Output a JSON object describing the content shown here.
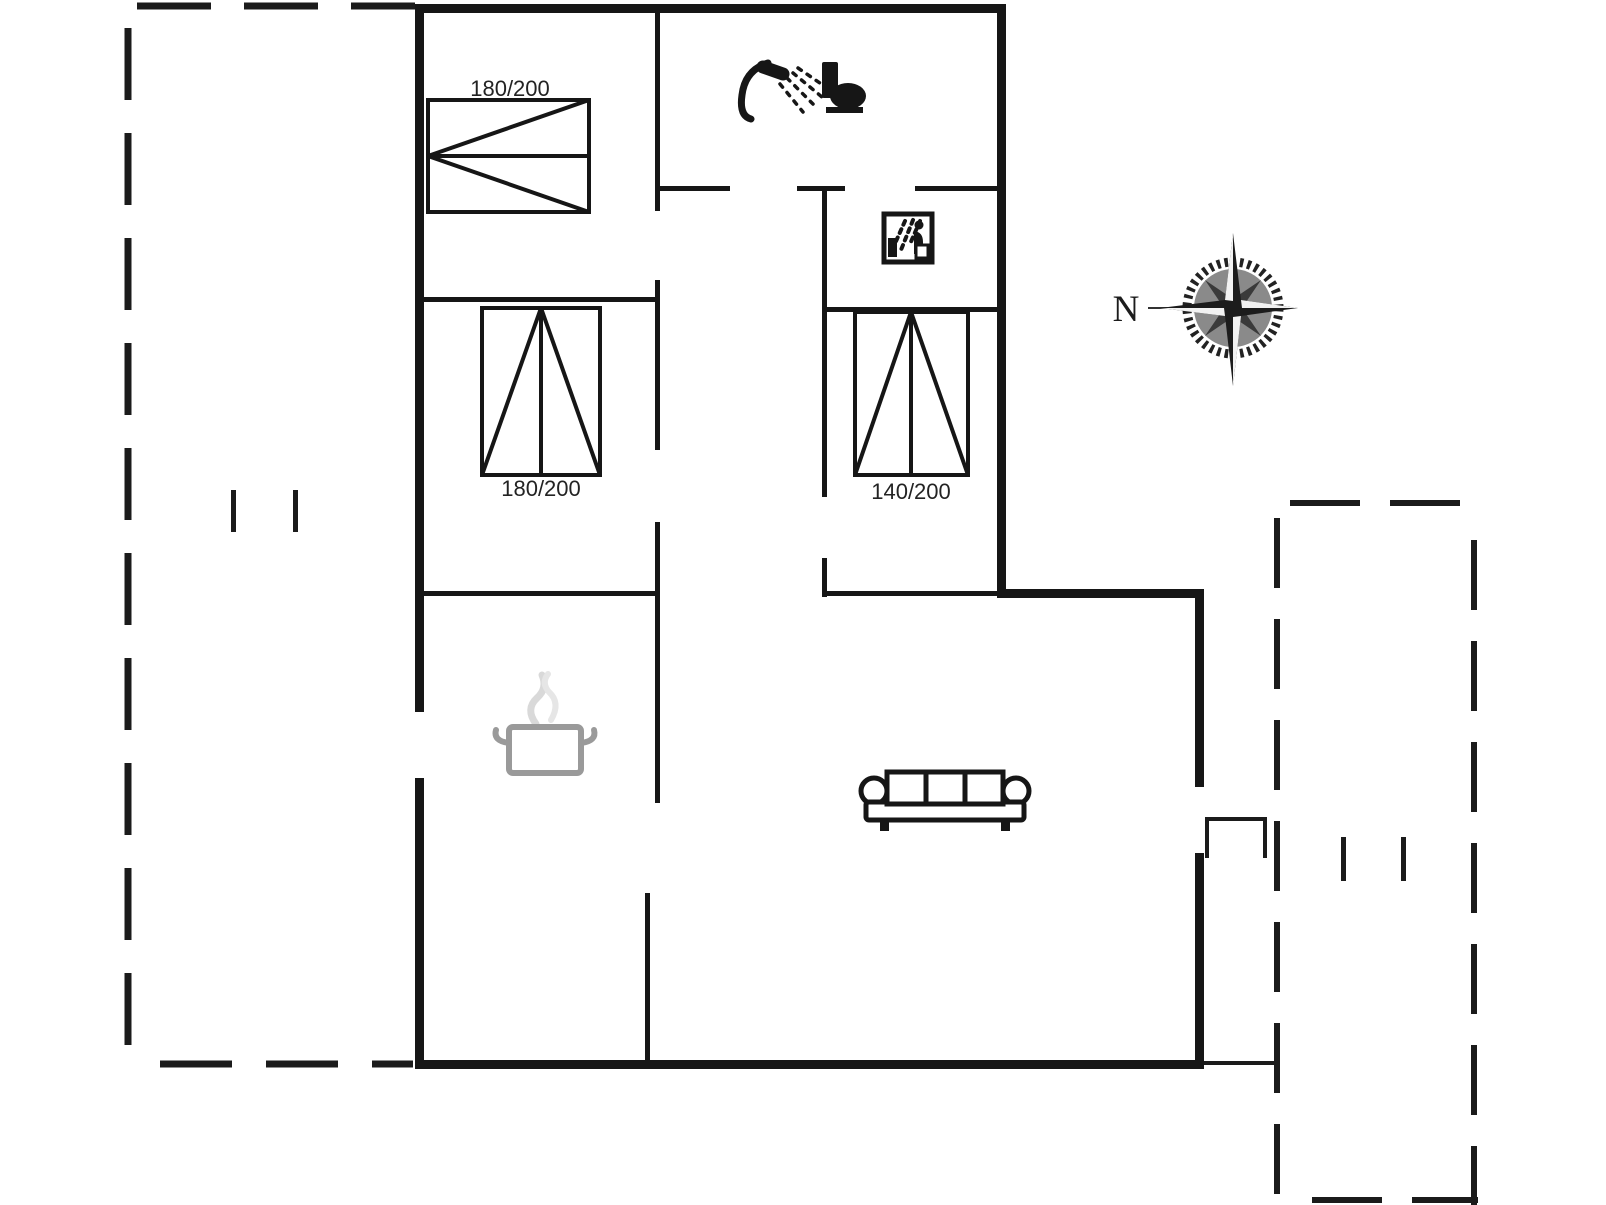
{
  "floor_plan": {
    "type": "holiday-house floor plan, black line drawing on white",
    "bedroom_1": {
      "bed_size": "180/200"
    },
    "bedroom_2": {
      "bed_size": "180/200"
    },
    "bedroom_3": {
      "bed_size": "140/200"
    },
    "compass": {
      "north_label": "N"
    },
    "icons": [
      "shower-icon",
      "toilet-icon",
      "sauna-spray-icon",
      "cooking-pot-icon",
      "sofa-icon",
      "compass-rose-icon"
    ],
    "colors": {
      "line": "#161616",
      "pot_outline": "#9a9a9a",
      "steam": "#d9d9d9",
      "compass_shade": "#8a8a8a"
    }
  }
}
